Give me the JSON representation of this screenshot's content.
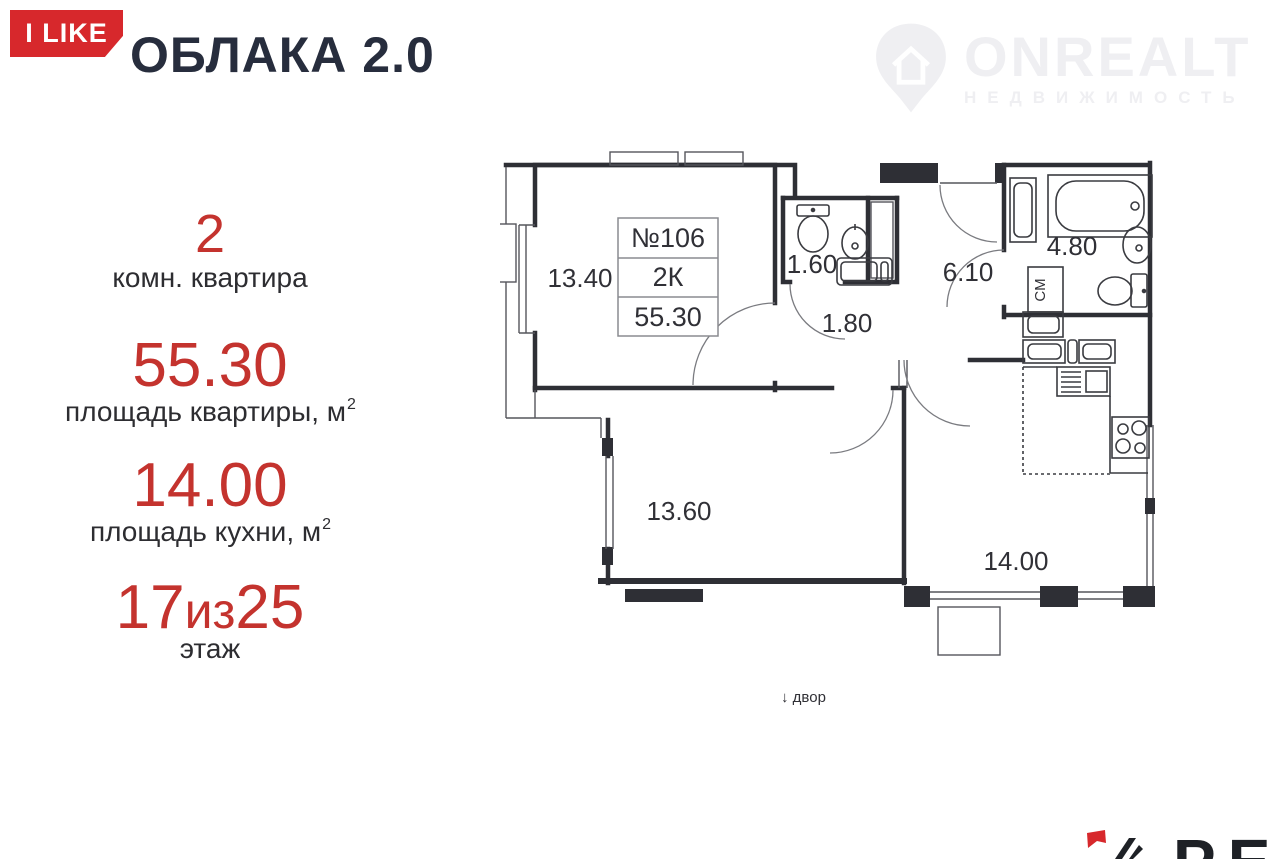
{
  "header": {
    "badge": "I LIKE",
    "title": "ОБЛАКА 2.0",
    "watermark": {
      "brand": "ONREALT",
      "tagline": "НЕДВИЖИМОСТЬ"
    }
  },
  "summary": {
    "rooms": {
      "value": "2",
      "label": "комн. квартира"
    },
    "apartment_area": {
      "value": "55.30",
      "label": "площадь квартиры, м",
      "sup": "2"
    },
    "kitchen_area": {
      "value": "14.00",
      "label": "площадь кухни, м",
      "sup": "2"
    },
    "floor": {
      "current": "17",
      "separator": "из",
      "total": "25",
      "label": "этаж"
    }
  },
  "plan": {
    "info": {
      "number": "№106",
      "type": "2К",
      "area": "55.30"
    },
    "labels": {
      "room1": "13.40",
      "wc": "1.60",
      "hall": "1.80",
      "corridor": "6.10",
      "bathroom": "4.80",
      "room2": "13.60",
      "kitchen_living": "14.00",
      "washing_machine": "СМ",
      "yard": "↓ двор"
    }
  },
  "footer": {
    "partner": "РЕД"
  },
  "colors": {
    "accent": "#c4332e",
    "badge": "#d7282c",
    "title": "#272d3d",
    "plan_line": "#2e2f35",
    "muted": "#a8adb3",
    "watermark": "#efeff2"
  }
}
